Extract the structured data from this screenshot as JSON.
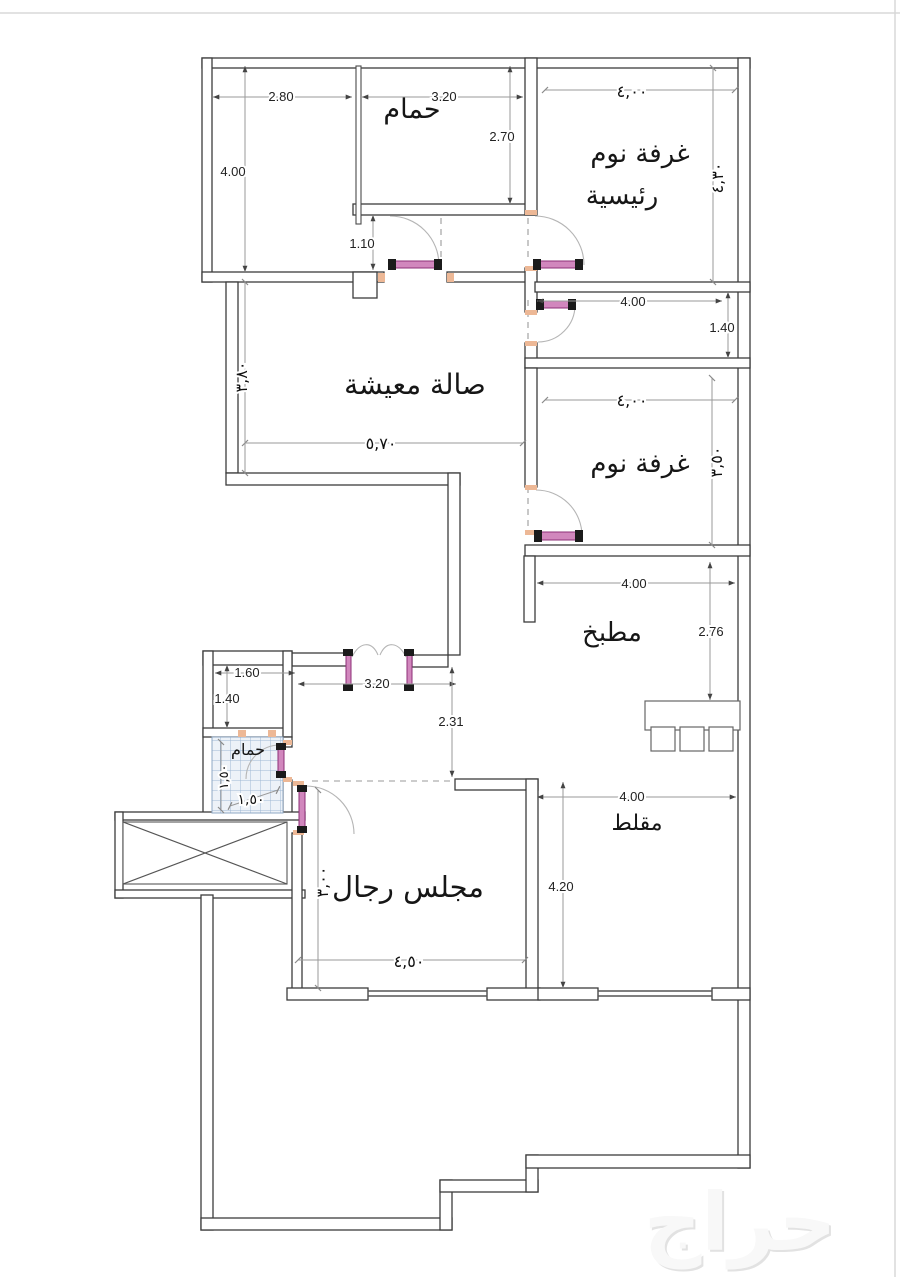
{
  "document": {
    "type": "apartment-floor-plan",
    "watermark": "حراج"
  },
  "rooms": {
    "bath_top": "حمام",
    "master_bedroom_line1": "غرفة نوم",
    "master_bedroom_line2": "رئيسية",
    "living": "صالة معيشة",
    "bedroom2": "غرفة نوم",
    "kitchen": "مطبخ",
    "bath_small": "حمام",
    "majlis": "مجلس رجال",
    "muqallat": "مقلط"
  },
  "dims": {
    "tl_width_left": "2.80",
    "bath_top_width": "3.20",
    "bath_top_height": "2.70",
    "tl_height": "4.00",
    "tl_gap": "1.10",
    "master_width": "٤,٠٠",
    "master_height": "٤,٣٠",
    "corridor_width": "4.00",
    "corridor_height": "1.40",
    "living_width": "٥,٧٠",
    "living_height": "٣,٨٠",
    "bedroom2_width": "٤,٠٠",
    "bedroom2_height": "٣,٥٠",
    "kitchen_width": "4.00",
    "kitchen_height": "2.76",
    "hall_width": "1.60",
    "hall_height": "1.40",
    "entry_width": "3.20",
    "entry_height": "2.31",
    "bath_small_height": "١,٥٠",
    "bath_small_width": "١,٥٠",
    "majlis_width": "٤,٥٠",
    "majlis_height": "٣,٠٠",
    "muqallat_width": "4.00",
    "muqallat_height": "4.20"
  },
  "colors": {
    "door_accent": "#d187bd",
    "door_edge": "#8d2f77",
    "tile": "#9fb8d4",
    "wall": "#3c3c3c",
    "dimension": "#9a9a9a"
  }
}
